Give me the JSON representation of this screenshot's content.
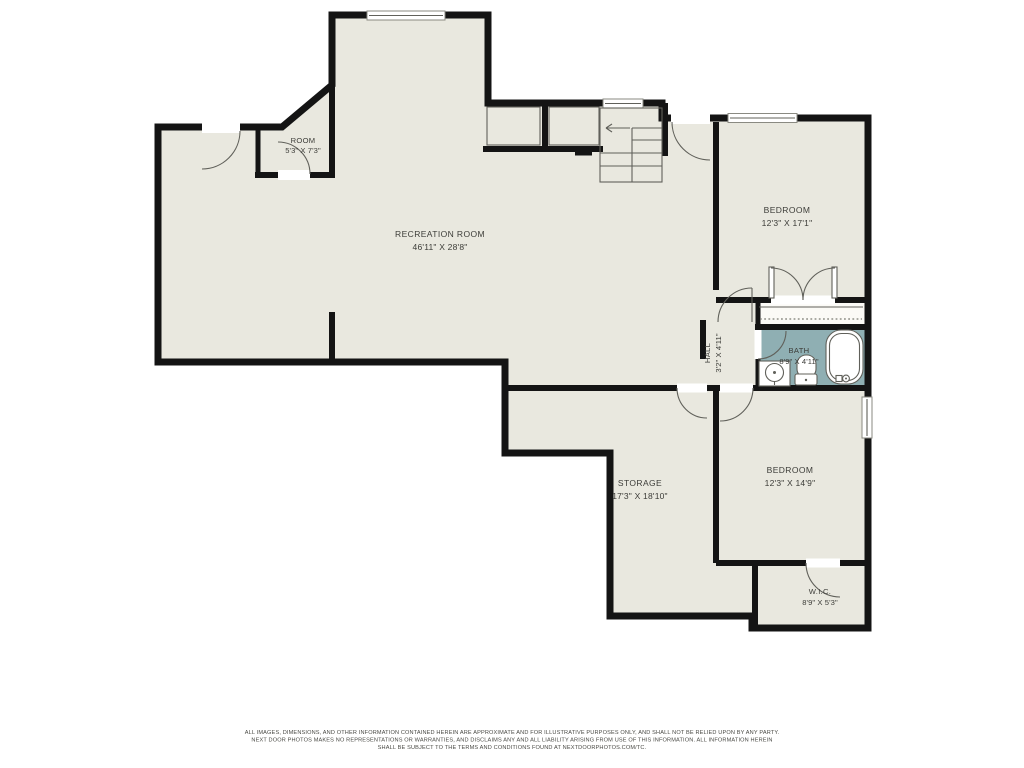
{
  "plan": {
    "rooms": [
      {
        "name": "ROOM",
        "dims": "5'3\" X 7'3\""
      },
      {
        "name": "RECREATION ROOM",
        "dims": "46'11\" X 28'8\""
      },
      {
        "name": "BEDROOM",
        "dims": "12'3\" X 17'1\""
      },
      {
        "name": "HALL",
        "dims": "3'2\" X 4'11\""
      },
      {
        "name": "BATH",
        "dims": "8'9\" X 4'11\""
      },
      {
        "name": "STORAGE",
        "dims": "17'3\" X 18'10\""
      },
      {
        "name": "BEDROOM",
        "dims": "12'3\" X 14'9\""
      },
      {
        "name": "W.I.C.",
        "dims": "8'9\" X 5'3\""
      }
    ],
    "colors": {
      "floor": "#e9e8df",
      "closet_floor": "#fbfaf6",
      "bath_floor": "#8fafb3",
      "wall": "#141414"
    },
    "footer": {
      "line1": "ALL IMAGES, DIMENSIONS, AND OTHER INFORMATION CONTAINED HEREIN ARE APPROXIMATE AND FOR ILLUSTRATIVE PURPOSES ONLY, AND SHALL NOT BE RELIED UPON BY ANY PARTY.",
      "line2": "NEXT DOOR PHOTOS MAKES NO REPRESENTATIONS OR WARRANTIES, AND DISCLAIMS ANY AND ALL LIABILITY ARISING FROM USE OF THIS INFORMATION. ALL INFORMATION HEREIN",
      "line3": "SHALL BE SUBJECT TO THE TERMS AND CONDITIONS FOUND AT NEXTDOORPHOTOS.COM/TC."
    }
  }
}
